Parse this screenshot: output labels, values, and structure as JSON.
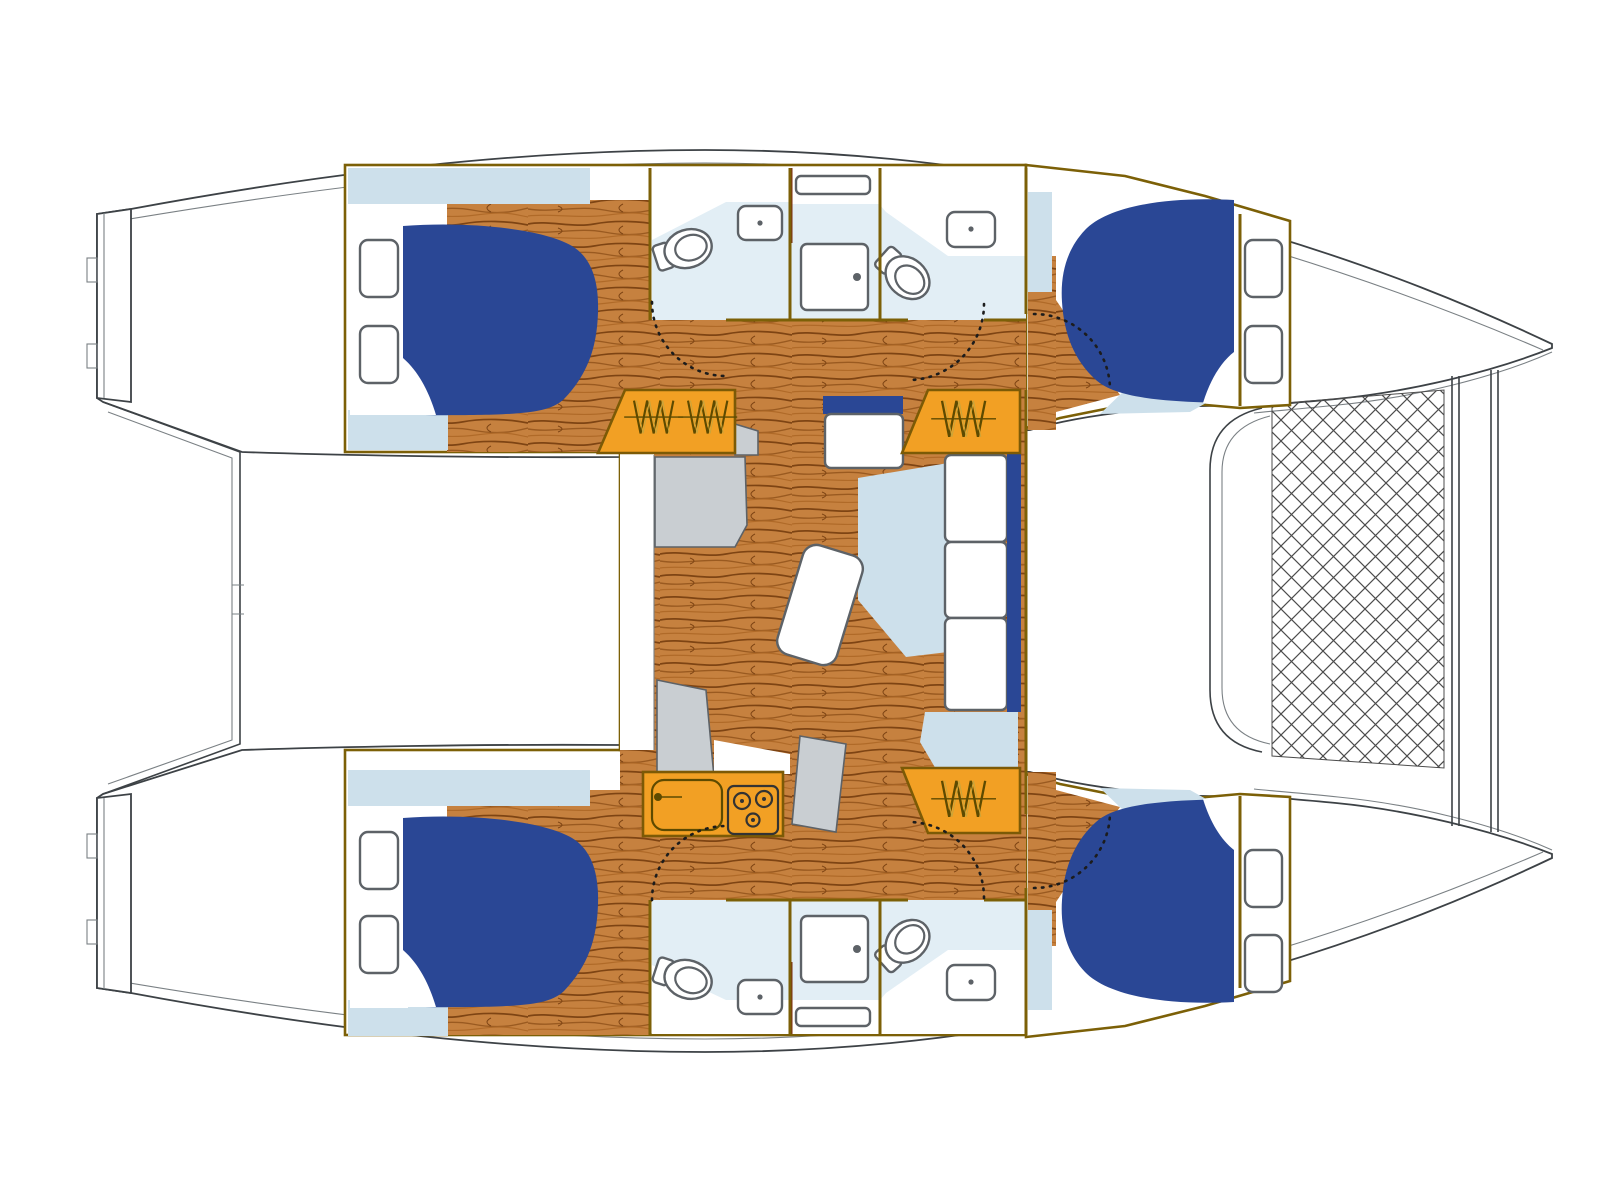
{
  "title": "Catamaran yacht interior deck plan — four double cabins, four heads, two showers, saloon with table and settee, galley, three companionways and bow trampoline",
  "colors": {
    "wood": "#c6813f",
    "woodDark": "#7e4413",
    "woodMid": "#9a5a20",
    "woodLight": "#b06a28",
    "orange": "#f2a024",
    "orangeEdge": "#7c5a06",
    "bedBlue": "#2a4795",
    "lightBlue": "#cde0eb",
    "bathFloor": "#e2eef5",
    "counterGray": "#c9ced2",
    "wall": "#7c6007",
    "hullLine": "#3d4246",
    "hullLight": "#7a8084",
    "fixture": "#5d6267",
    "doorArc": "#1c1c1c",
    "net": "#4c4c4c",
    "coil": "#5d4a00",
    "coilHi": "#caa53a",
    "maroon": "#7c2d12",
    "white": "#ffffff"
  },
  "vessel": {
    "type": "catamaran",
    "view": "overhead floor plan",
    "hulls": 2,
    "layout": "4 cabins / 4 heads",
    "bow": "right (trampoline)",
    "stern": "left (twin transoms)"
  },
  "rooms": [
    {
      "id": "cabin-top-aft",
      "name": "double cabin",
      "berth": "double",
      "hatches": 2
    },
    {
      "id": "cabin-top-forward",
      "name": "double cabin",
      "berth": "double",
      "hatches": 2
    },
    {
      "id": "cabin-bottom-aft",
      "name": "double cabin",
      "berth": "double",
      "hatches": 2
    },
    {
      "id": "cabin-bottom-forward",
      "name": "double cabin",
      "berth": "double",
      "hatches": 2
    },
    {
      "id": "head-top-aft",
      "fixtures": [
        "toilet",
        "sink"
      ]
    },
    {
      "id": "shower-top",
      "fixtures": [
        "shower-stall"
      ]
    },
    {
      "id": "head-top-forward",
      "fixtures": [
        "toilet",
        "sink"
      ]
    },
    {
      "id": "head-bottom-aft",
      "fixtures": [
        "toilet",
        "sink"
      ]
    },
    {
      "id": "shower-bottom",
      "fixtures": [
        "shower-stall"
      ]
    },
    {
      "id": "head-bottom-forward",
      "fixtures": [
        "toilet",
        "sink"
      ]
    },
    {
      "id": "saloon",
      "furniture": [
        "dining-table",
        "angled-settee",
        "three-seat-cushions",
        "sideboard",
        "counters"
      ]
    },
    {
      "id": "galley",
      "fixtures": [
        "sink-with-faucet",
        "three-burner-stove"
      ]
    }
  ],
  "counts": {
    "beds": 4,
    "deck_hatches": 8,
    "toilets": 4,
    "bathroom_sinks": 4,
    "showers": 2,
    "skylights": 2,
    "companionway_stairs": 3,
    "door_swings": 6,
    "tables": 1,
    "stove_burners": 3,
    "crossbeams": 2
  },
  "trampoline": {
    "pattern": "diamond net",
    "position": "between bows"
  }
}
